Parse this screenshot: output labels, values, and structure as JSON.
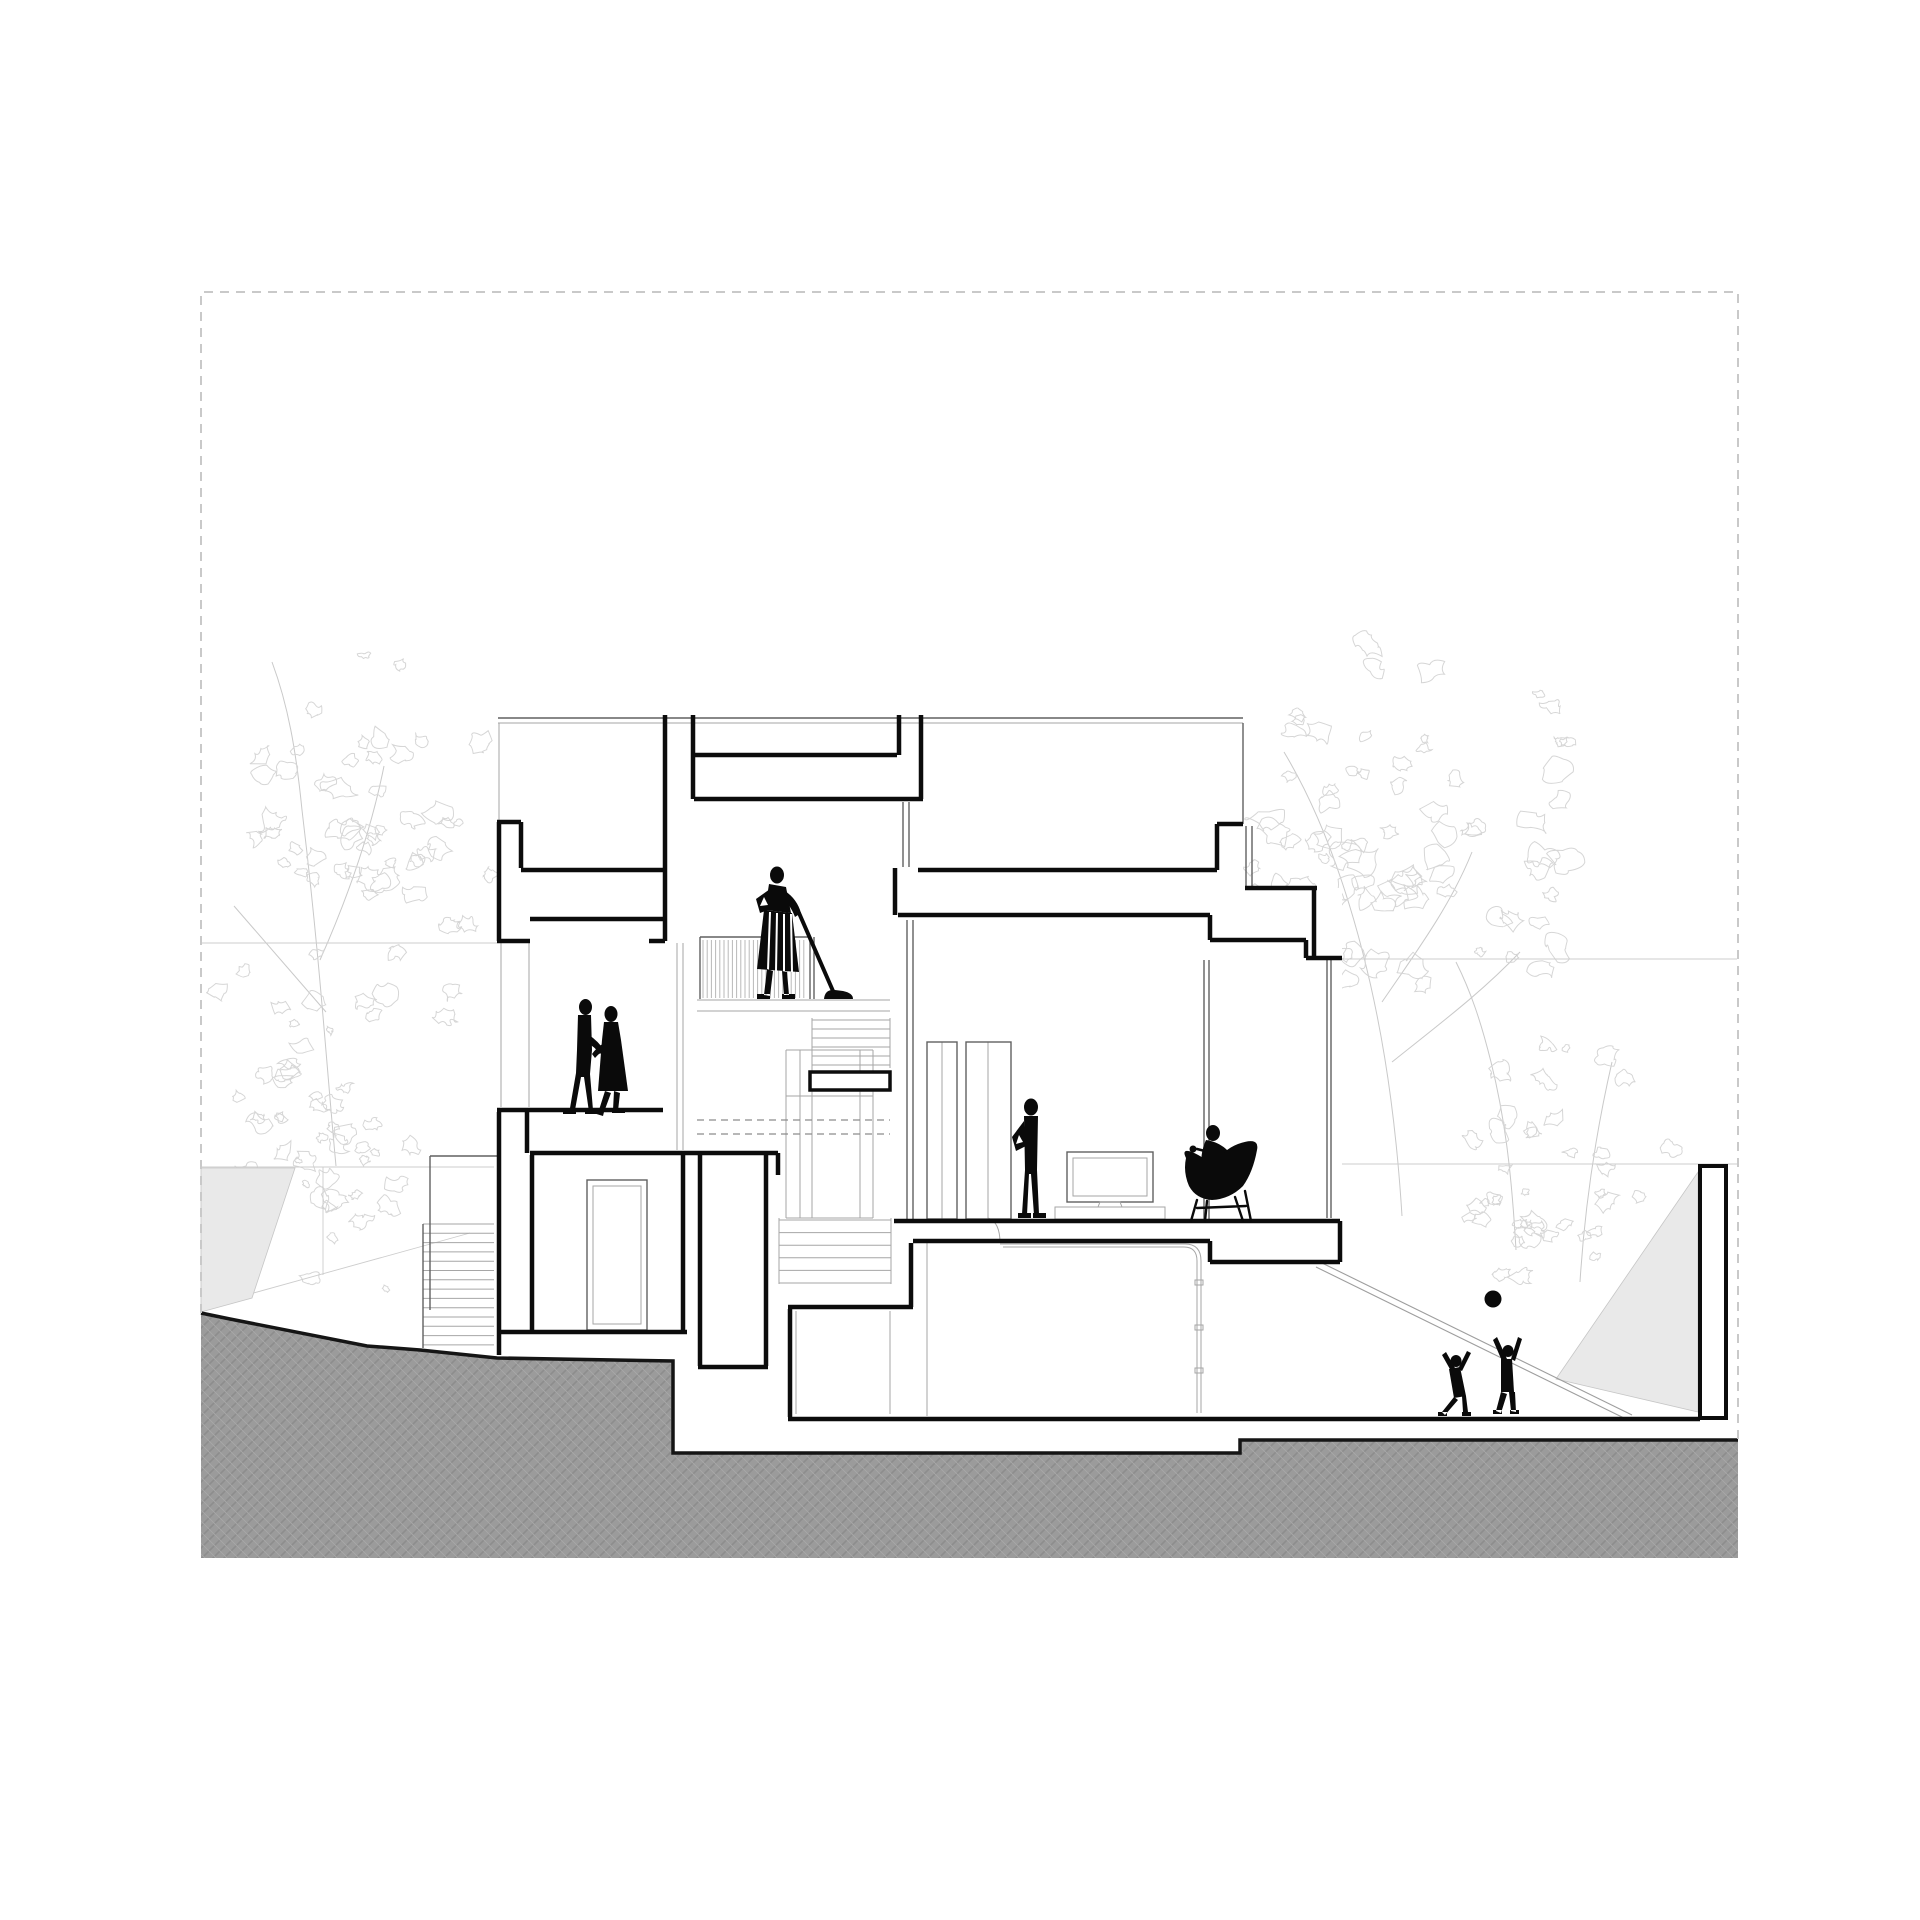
{
  "meta": {
    "drawing_type": "architectural-building-section",
    "sheet": "white sheet with dashed trim border"
  },
  "canvas": {
    "width": 1920,
    "height": 1920
  },
  "palette": {
    "paper": "#ffffff",
    "cut_line": "#0c0c0c",
    "medium_line": "#606060",
    "light_line": "#a6a6a6",
    "faint_line": "#cdcdcd",
    "tree_line": "#d6d6d6",
    "trunk_line": "#c9c9c9",
    "border_dash": "#c9c9c9",
    "hidden_dash": "#8c8c8c",
    "ground_base": "#9b9b9b",
    "ground_hatch_dark": "#8d8d8d",
    "ground_hatch_light": "#a8a8a8",
    "ground_edge": "#151515",
    "wedge_fill": "#e9e9e9",
    "figure_fill": "#0a0a0a"
  },
  "styles": {
    "cut": {
      "stroke": "#0c0c0c",
      "width": 4.5,
      "fill": "none"
    },
    "med": {
      "stroke": "#606060",
      "width": 1.4,
      "fill": "none"
    },
    "light": {
      "stroke": "#a6a6a6",
      "width": 1.0,
      "fill": "none"
    },
    "faint": {
      "stroke": "#cdcdcd",
      "width": 0.9,
      "fill": "none"
    },
    "ramp": {
      "stroke": "#9e9e9e",
      "width": 1.1,
      "fill": "none"
    },
    "tree": {
      "stroke": "#d6d6d6",
      "width": 1.0,
      "fill": "none"
    },
    "trunk": {
      "stroke": "#c9c9c9",
      "width": 1.0,
      "fill": "none"
    },
    "bars": {
      "stroke": "#b8b8b8",
      "width": 1.0,
      "fill": "none"
    },
    "hidden": {
      "stroke": "#8c8c8c",
      "width": 1.2,
      "fill": "none",
      "dash": "7 5"
    },
    "border": {
      "stroke": "#c9c9c9",
      "width": 2.0,
      "fill": "none",
      "dash": "9 7"
    },
    "gedge": {
      "stroke": "#151515",
      "width": 3.5,
      "fill": "none"
    },
    "white": {
      "stroke": "none",
      "width": 0,
      "fill": "#ffffff"
    },
    "ground": {
      "stroke": "none",
      "width": 0,
      "fill": "url(#hatch)"
    },
    "wedge": {
      "stroke": "#c6c6c6",
      "width": 0.8,
      "fill": "#e9e9e9"
    },
    "wallrect": {
      "stroke": "#0c0c0c",
      "width": 4.0,
      "fill": "#ffffff"
    },
    "beamrect": {
      "stroke": "#0c0c0c",
      "width": 3.5,
      "fill": "#ffffff"
    },
    "fig": {
      "stroke": "none",
      "width": 0,
      "fill": "#0a0a0a"
    },
    "figline": {
      "stroke": "#0a0a0a",
      "width": 4.0,
      "fill": "none",
      "cap": "round"
    },
    "cupline": {
      "stroke": "#0a0a0a",
      "width": 2.6,
      "fill": "none",
      "cap": "round"
    },
    "leg": {
      "stroke": "#0a0a0a",
      "width": 2.4,
      "fill": "none",
      "cap": "round"
    },
    "stripe": {
      "stroke": "#ffffff",
      "width": 2.0,
      "fill": "none"
    },
    "hole": {
      "stroke": "none",
      "width": 0,
      "fill": "#ffffff"
    }
  },
  "layers": [
    {
      "n": "tree-trunk",
      "t": "path",
      "cls": "trunk",
      "d": "M336,1166 C326,1060 320,960 302,810 C296,750 288,705 272,662"
    },
    {
      "n": "tree-trunk",
      "t": "path",
      "cls": "trunk",
      "d": "M320,960 C352,888 372,826 384,766"
    },
    {
      "n": "tree-trunk",
      "t": "path",
      "cls": "trunk",
      "d": "M326,1012 C284,964 258,934 234,906"
    },
    {
      "n": "tree-trunk",
      "t": "path",
      "cls": "trunk",
      "d": "M1402,1216 C1396,1120 1382,1002 1342,882 C1322,822 1302,782 1284,752"
    },
    {
      "n": "tree-trunk",
      "t": "path",
      "cls": "trunk",
      "d": "M1382,1002 C1422,944 1452,902 1472,852"
    },
    {
      "n": "tree-trunk",
      "t": "path",
      "cls": "trunk",
      "d": "M1392,1062 C1442,1022 1482,992 1520,952"
    },
    {
      "n": "tree-trunk",
      "t": "path",
      "cls": "trunk",
      "d": "M1516,1250 C1512,1180 1506,1122 1491,1062 C1481,1022 1471,992 1456,962"
    },
    {
      "n": "tree-trunk",
      "t": "path",
      "cls": "trunk",
      "d": "M1580,1282 C1585,1202 1596,1132 1612,1062"
    },
    {
      "n": "tree-left-canopy",
      "t": "scrib",
      "cls": "tree",
      "x": 205,
      "y": 640,
      "w": 315,
      "h": 420,
      "count": 60,
      "rmin": 5,
      "rmax": 15,
      "seed": 7
    },
    {
      "n": "tree-left-low",
      "t": "scrib",
      "cls": "tree",
      "x": 205,
      "y": 985,
      "w": 235,
      "h": 320,
      "count": 45,
      "rmin": 4,
      "rmax": 13,
      "seed": 11
    },
    {
      "n": "tree-right-canopy",
      "t": "scrib",
      "cls": "tree",
      "x": 1145,
      "y": 615,
      "w": 460,
      "h": 450,
      "count": 85,
      "rmin": 5,
      "rmax": 16,
      "seed": 3
    },
    {
      "n": "tree-right-low",
      "t": "scrib",
      "cls": "tree",
      "x": 1455,
      "y": 1030,
      "w": 240,
      "h": 300,
      "count": 30,
      "rmin": 4,
      "rmax": 12,
      "seed": 13
    },
    {
      "n": "tree-right-under",
      "t": "scrib",
      "cls": "tree",
      "x": 1420,
      "y": 1170,
      "w": 150,
      "h": 95,
      "count": 10,
      "rmin": 4,
      "rmax": 9,
      "seed": 17
    },
    {
      "n": "background-level-lines",
      "t": "path",
      "cls": "faint",
      "d": "M201,943 L497,943 M201,1167 L494,1167 M257,1167 L257,1282 M323,1167 L323,1275 M203,1307 L470,1233 M1322,959 L1737,959 M1342,1164 L1737,1164"
    },
    {
      "n": "ramp-side-wall-left",
      "t": "poly",
      "cls": "wedge",
      "pts": "201,1168 295,1168 252,1298 201,1312"
    },
    {
      "n": "ramp-side-wall-right",
      "t": "poly",
      "cls": "wedge",
      "pts": "1698,1172 1698,1412 1556,1379"
    },
    {
      "n": "garden-ramp",
      "t": "path",
      "cls": "ramp",
      "d": "M1322,1263 L1632,1415 M1316,1267 L1626,1419"
    },
    {
      "n": "building-mass",
      "t": "rect",
      "cls": "white",
      "x": 497,
      "y": 715,
      "w": 426,
      "h": 438
    },
    {
      "n": "building-mass",
      "t": "rect",
      "cls": "white",
      "x": 918,
      "y": 715,
      "w": 325,
      "h": 173
    },
    {
      "n": "building-mass",
      "t": "rect",
      "cls": "white",
      "x": 893,
      "y": 888,
      "w": 449,
      "h": 333
    },
    {
      "n": "building-mass",
      "t": "rect",
      "cls": "white",
      "x": 497,
      "y": 1110,
      "w": 281,
      "h": 309
    },
    {
      "n": "building-mass",
      "t": "rect",
      "cls": "white",
      "x": 788,
      "y": 1221,
      "w": 452,
      "h": 198
    },
    {
      "n": "ground-mass",
      "t": "poly",
      "cls": "ground",
      "pts": "201,1313 230,1319 367,1346 420,1350 497,1358 673,1361 673,1453 1240,1453 1240,1440 1738,1440 1738,1558 201,1558"
    },
    {
      "n": "ground-edge",
      "t": "path",
      "cls": "gedge",
      "d": "M201,1313 L230,1319 L367,1346 L420,1350 L497,1358 L673,1361 L673,1453 L1240,1453 L1240,1440 L1738,1440"
    },
    {
      "n": "outdoor-stair-steps",
      "t": "hsteps",
      "cls": "light",
      "x1": 423,
      "x2": 494,
      "y0": 1224,
      "dy": 9.3,
      "count": 14
    },
    {
      "n": "outdoor-stair-rail",
      "t": "path",
      "cls": "med",
      "d": "M430,1156 L430,1310 M430,1156 L497,1156 M423,1224 L423,1348"
    },
    {
      "n": "elevation-light-lines",
      "t": "path",
      "cls": "light",
      "d": "M498,723 L1243,723 M499,723 L499,820 M697,1000 L890,1000 M697,1011 L890,1011 M501,943 L501,1107 M529,943 L529,1107 M677,943 L677,1150 M683,943 L683,1150 M812,1018 L812,1068 M890,1018 L890,1068 M786,1050 L786,1218 M873,1050 L873,1218 M786,1050 L873,1050 M786,1218 L873,1218 M800,1050 L800,1218 M812,1050 L812,1218 M860,1050 L860,1218 M786,1096 L873,1096 M779,1218 L779,1284 M891,1218 L891,1284 M988,1218 Q1000,1222 1000,1243 M1000,1244 L1185,1244 Q1201,1244 1201,1261 L1201,1413 M1003,1247 L1184,1247 Q1197,1247 1197,1261 L1197,1413 M796,1311 L796,1414 M890,1311 L890,1414 M927,1243 L927,1416 M942,1042 L942,1219 M988,1042 L988,1219"
    },
    {
      "n": "glass-clip",
      "t": "rect",
      "cls": "light",
      "x": 1195,
      "y": 1280,
      "w": 8,
      "h": 5
    },
    {
      "n": "glass-clip",
      "t": "rect",
      "cls": "light",
      "x": 1195,
      "y": 1325,
      "w": 8,
      "h": 5
    },
    {
      "n": "glass-clip",
      "t": "rect",
      "cls": "light",
      "x": 1195,
      "y": 1368,
      "w": 8,
      "h": 5
    },
    {
      "n": "stair-upper-flight",
      "t": "hsteps",
      "cls": "light",
      "x1": 812,
      "x2": 890,
      "y0": 1020,
      "dy": 9,
      "count": 6
    },
    {
      "n": "stair-lower-flight",
      "t": "hsteps",
      "cls": "light",
      "x1": 779,
      "x2": 891,
      "y0": 1220,
      "dy": 12.6,
      "count": 6
    },
    {
      "n": "balcony-railing-bars",
      "t": "bars",
      "cls": "bars",
      "x1": 703,
      "x2": 808,
      "step": 4.2,
      "y1": 940,
      "y2": 998
    },
    {
      "n": "balcony-railing-frame",
      "t": "path",
      "cls": "med",
      "d": "M700,937 L810,937 M700,937 L700,999 M810,937 L810,999 M814,937 L814,999"
    },
    {
      "n": "structure-medium-lines",
      "t": "path",
      "cls": "med",
      "d": "M498,718 L1243,718 M1243,723 L1243,824 M903,802 L903,867 M909,802 L909,867 M1246,826 L1246,887 M1252,826 L1252,887 M907,920 L907,1221 M913,920 L913,1221 M1204,960 L1204,1220 M1209,960 L1209,1220 M1327,960 L1327,1218 M1331,960 L1331,1218"
    },
    {
      "n": "hidden-stair-dashes",
      "t": "path",
      "cls": "hidden",
      "d": "M697,1120 L890,1120 M697,1134 L890,1134"
    },
    {
      "n": "living-window",
      "t": "rect",
      "cls": "med",
      "x": 927,
      "y": 1042,
      "w": 30,
      "h": 177
    },
    {
      "n": "living-window",
      "t": "rect",
      "cls": "med",
      "x": 966,
      "y": 1042,
      "w": 45,
      "h": 177
    },
    {
      "n": "entry-door-frame",
      "t": "rect",
      "cls": "med",
      "x": 587,
      "y": 1180,
      "w": 60,
      "h": 150
    },
    {
      "n": "entry-door-leaf",
      "t": "rect",
      "cls": "light",
      "x": 593,
      "y": 1186,
      "w": 48,
      "h": 138
    },
    {
      "n": "tv-screen",
      "t": "rect",
      "cls": "med",
      "x": 1067,
      "y": 1152,
      "w": 86,
      "h": 50
    },
    {
      "n": "tv-screen-inner",
      "t": "rect",
      "cls": "light",
      "x": 1073,
      "y": 1158,
      "w": 74,
      "h": 38
    },
    {
      "n": "tv-stand",
      "t": "path",
      "cls": "light",
      "d": "M1100,1202 L1120,1202 L1122,1207 L1098,1207 Z"
    },
    {
      "n": "media-cabinet",
      "t": "rect",
      "cls": "light",
      "x": 1055,
      "y": 1207,
      "w": 110,
      "h": 12
    },
    {
      "n": "section-cut-lines",
      "t": "path",
      "cls": "cut",
      "d": "M499,822 L499,941 M497,822 L521,822 M521,822 L521,868 M521,870 L663,870 M497,941 L530,941 M530,919 L663,919 M665,715 L665,941 M649,941 L665,941 M693,715 L693,799 M694,755 L897,755 M694,799 L923,799 M899,715 L899,755 M921,715 L921,799 M918,870 L1217,870 M1217,824 L1217,870 M1217,824 L1243,824 M895,868 L895,915 M898,915 L1210,915 M1210,915 L1210,940 M1210,940 L1306,940 M1306,940 L1306,958 M1306,958 L1342,958 M1314,890 L1314,958 M1245,888 L1317,888 M894,1221 L1340,1221 M1340,1221 L1340,1262 M1210,1241 L1210,1262 M1210,1262 L1340,1262 M913,1241 L1210,1241 M911,1243 L911,1307 M788,1307 L913,1307 M790,1309 L790,1417 M499,1112 L499,1355 M527,1112 L527,1153 M497,1110 L663,1110 M530,1153 L778,1153 M532,1155 L532,1330 M683,1155 L683,1330 M497,1332 L687,1332 M700,1153 L700,1366 M766,1153 L766,1366 M698,1367 L768,1367 M778,1153 L778,1175 M788,1419 L1700,1419"
    },
    {
      "n": "landing-edge-beam",
      "t": "rect",
      "cls": "beamrect",
      "x": 810,
      "y": 1072,
      "w": 80,
      "h": 18
    },
    {
      "n": "boundary-wall",
      "t": "rect",
      "cls": "wallrect",
      "x": 1700,
      "y": 1166,
      "w": 26,
      "h": 252
    },
    {
      "n": "dancing-man-head",
      "t": "ellipse",
      "cls": "fig",
      "cx": 585.5,
      "cy": 1007,
      "rx": 6.5,
      "ry": 8
    },
    {
      "n": "dancing-man-body",
      "t": "path",
      "cls": "fig",
      "d": "M578,1015 L591,1015 L592,1050 L590,1074 L593,1110 L589,1112 L584,1077 L581,1077 L575,1110 L570,1108 L576,1073 L577,1050 Z"
    },
    {
      "n": "dancing-man-arm",
      "t": "path",
      "cls": "fig",
      "d": "M589,1035 Q598,1041 604,1050 L600,1054 Q594,1046 587,1043 Z"
    },
    {
      "n": "dancing-man-feet",
      "t": "path",
      "cls": "fig",
      "d": "M563,1110 L576,1110 L576,1114 L563,1114 Z M585,1110 L598,1110 L598,1114 L585,1114 Z"
    },
    {
      "n": "dancing-woman-head",
      "t": "ellipse",
      "cls": "fig",
      "cx": 611,
      "cy": 1014,
      "rx": 6.5,
      "ry": 8
    },
    {
      "n": "dancing-woman-dress",
      "t": "path",
      "cls": "fig",
      "d": "M604,1022 L618,1022 L621,1040 L628,1091 L598,1091 L602,1040 Z"
    },
    {
      "n": "dancing-woman-arm",
      "t": "path",
      "cls": "fig",
      "d": "M604,1043 Q596,1048 592,1054 L595,1058 Q600,1052 607,1049 Z"
    },
    {
      "n": "dancing-woman-legs",
      "t": "path",
      "cls": "fig",
      "d": "M605,1091 L599,1110 L604,1112 L611,1093 Z M614,1091 L613,1110 L618,1111 L620,1093 Z M591,1108 L604,1112 L603,1116 L590,1112 Z M612,1109 L625,1109 L625,1113 L612,1113 Z"
    },
    {
      "n": "vacuum-person-head",
      "t": "ellipse",
      "cls": "fig",
      "cx": 777,
      "cy": 875,
      "rx": 7,
      "ry": 8.5
    },
    {
      "n": "vacuum-person-torso",
      "t": "path",
      "cls": "fig",
      "d": "M769,884 L786,887 L791,913 L765,910 Z"
    },
    {
      "n": "vacuum-person-arm-akimbo",
      "t": "path",
      "cls": "fig",
      "d": "M770,889 L756,899 L760,913 L771,909 Z"
    },
    {
      "n": "vacuum-person-arm-hole",
      "t": "path",
      "cls": "hole",
      "d": "M764,897 L760,906 L768,905 Z"
    },
    {
      "n": "vacuum-person-arm-reach",
      "t": "path",
      "cls": "fig",
      "d": "M785,891 Q797,899 801,913 L795,917 Q790,904 781,897 Z"
    },
    {
      "n": "vacuum-person-skirt",
      "t": "path",
      "cls": "fig",
      "d": "M764,910 L792,913 L799,972 L757,969 Z"
    },
    {
      "n": "vacuum-skirt-stripes",
      "t": "path",
      "cls": "stripe",
      "d": "M770,912 L768,970 M777,913 L776,971 M784,914 L784,971 M791,914 L792,972"
    },
    {
      "n": "vacuum-person-legs",
      "t": "path",
      "cls": "fig",
      "d": "M767,969 L764,995 L770,996 L773,971 Z M782,971 L784,995 L789,995 L787,972 Z M757,994 L770,994 L770,999 L757,999 Z M782,994 L795,994 L795,999 L782,999 Z"
    },
    {
      "n": "vacuum-handle",
      "t": "path",
      "cls": "figline",
      "d": "M799,913 L833,991"
    },
    {
      "n": "vacuum-head",
      "t": "path",
      "cls": "fig",
      "d": "M824,999 Q825,989 835,990 L843,991 Q853,993 853,999 Z"
    },
    {
      "n": "standing-person-head",
      "t": "ellipse",
      "cls": "fig",
      "cx": 1031,
      "cy": 1107,
      "rx": 7,
      "ry": 8.5
    },
    {
      "n": "standing-person-body",
      "t": "path",
      "cls": "fig",
      "d": "M1024,1116 L1038,1116 L1037,1170 L1039,1214 L1034,1215 L1031,1174 L1029,1174 L1027,1215 L1022,1214 L1025,1170 Z"
    },
    {
      "n": "standing-person-arm",
      "t": "path",
      "cls": "fig",
      "d": "M1024,1121 L1012,1137 L1016,1151 L1026,1146 Z"
    },
    {
      "n": "standing-person-arm-hole",
      "t": "path",
      "cls": "hole",
      "d": "M1019,1135 L1016,1144 L1023,1142 Z"
    },
    {
      "n": "standing-person-feet",
      "t": "path",
      "cls": "fig",
      "d": "M1018,1213 L1031,1213 L1031,1218 L1018,1218 Z M1033,1213 L1046,1213 L1046,1218 L1033,1218 Z"
    },
    {
      "n": "seated-person-head",
      "t": "ellipse",
      "cls": "fig",
      "cx": 1213,
      "cy": 1133,
      "rx": 7,
      "ry": 8
    },
    {
      "n": "seated-person-body",
      "t": "path",
      "cls": "fig",
      "d": "M1206,1140 Q1198,1158 1204,1172 L1222,1180 Q1232,1168 1229,1152 Q1220,1142 1206,1140 Z"
    },
    {
      "n": "lounge-chair-shell",
      "t": "path",
      "cls": "fig",
      "d": "M1186,1158 Q1181,1148 1192,1152 Q1206,1158 1213,1167 Q1222,1150 1238,1144 Q1260,1136 1257,1150 Q1253,1172 1243,1186 Q1230,1199 1212,1200 Q1196,1199 1189,1186 Q1183,1172 1186,1158 Z"
    },
    {
      "n": "seated-person-cup",
      "t": "circle",
      "cls": "fig",
      "cx": 1193,
      "cy": 1149,
      "r": 3.5
    },
    {
      "n": "seated-person-arm",
      "t": "path",
      "cls": "cupline",
      "d": "M1205,1151 L1197,1149"
    },
    {
      "n": "lounge-chair-legs",
      "t": "path",
      "cls": "leg",
      "d": "M1197,1200 L1191,1221 M1207,1201 L1205,1221 M1235,1197 L1243,1221 M1245,1191 L1251,1221 M1197,1208 L1246,1206"
    },
    {
      "n": "child-left-head",
      "t": "ellipse",
      "cls": "fig",
      "cx": 1456,
      "cy": 1361,
      "rx": 5.5,
      "ry": 6
    },
    {
      "n": "child-left-body",
      "t": "path",
      "cls": "fig",
      "d": "M1449,1369 L1460,1367 L1466,1396 L1454,1398 Z"
    },
    {
      "n": "child-left-arms",
      "t": "path",
      "cls": "fig",
      "d": "M1458,1369 L1467,1351 L1471,1353 L1462,1371 Z M1451,1371 L1442,1355 L1446,1352 L1455,1368 Z"
    },
    {
      "n": "child-left-legs",
      "t": "path",
      "cls": "fig",
      "d": "M1454,1397 L1442,1412 L1445,1415 L1458,1400 Z M1462,1396 L1463,1412 L1468,1412 L1466,1396 Z M1438,1412 L1447,1412 L1447,1416 L1438,1416 Z M1462,1412 L1471,1412 L1471,1416 L1462,1416 Z"
    },
    {
      "n": "child-right-head",
      "t": "ellipse",
      "cls": "fig",
      "cx": 1508,
      "cy": 1351,
      "rx": 5.5,
      "ry": 6
    },
    {
      "n": "child-right-body",
      "t": "path",
      "cls": "fig",
      "d": "M1501,1359 L1512,1359 L1514,1392 L1501,1392 Z"
    },
    {
      "n": "child-right-arms",
      "t": "path",
      "cls": "fig",
      "d": "M1502,1361 L1493,1340 L1497,1337 L1507,1359 Z M1511,1359 L1518,1337 L1522,1339 L1515,1361 Z"
    },
    {
      "n": "child-right-legs",
      "t": "path",
      "cls": "fig",
      "d": "M1501,1392 L1496,1411 L1501,1413 L1507,1394 Z M1509,1392 L1511,1411 L1516,1412 L1515,1392 Z M1493,1410 L1502,1410 L1502,1414 L1493,1414 Z M1510,1410 L1519,1410 L1519,1414 L1510,1414 Z"
    },
    {
      "n": "ball",
      "t": "circle",
      "cls": "fig",
      "cx": 1493,
      "cy": 1299,
      "r": 8.5
    },
    {
      "n": "trim-border",
      "t": "path",
      "cls": "border",
      "d": "M201,1313 L201,292 L1738,292 L1738,1439"
    }
  ]
}
